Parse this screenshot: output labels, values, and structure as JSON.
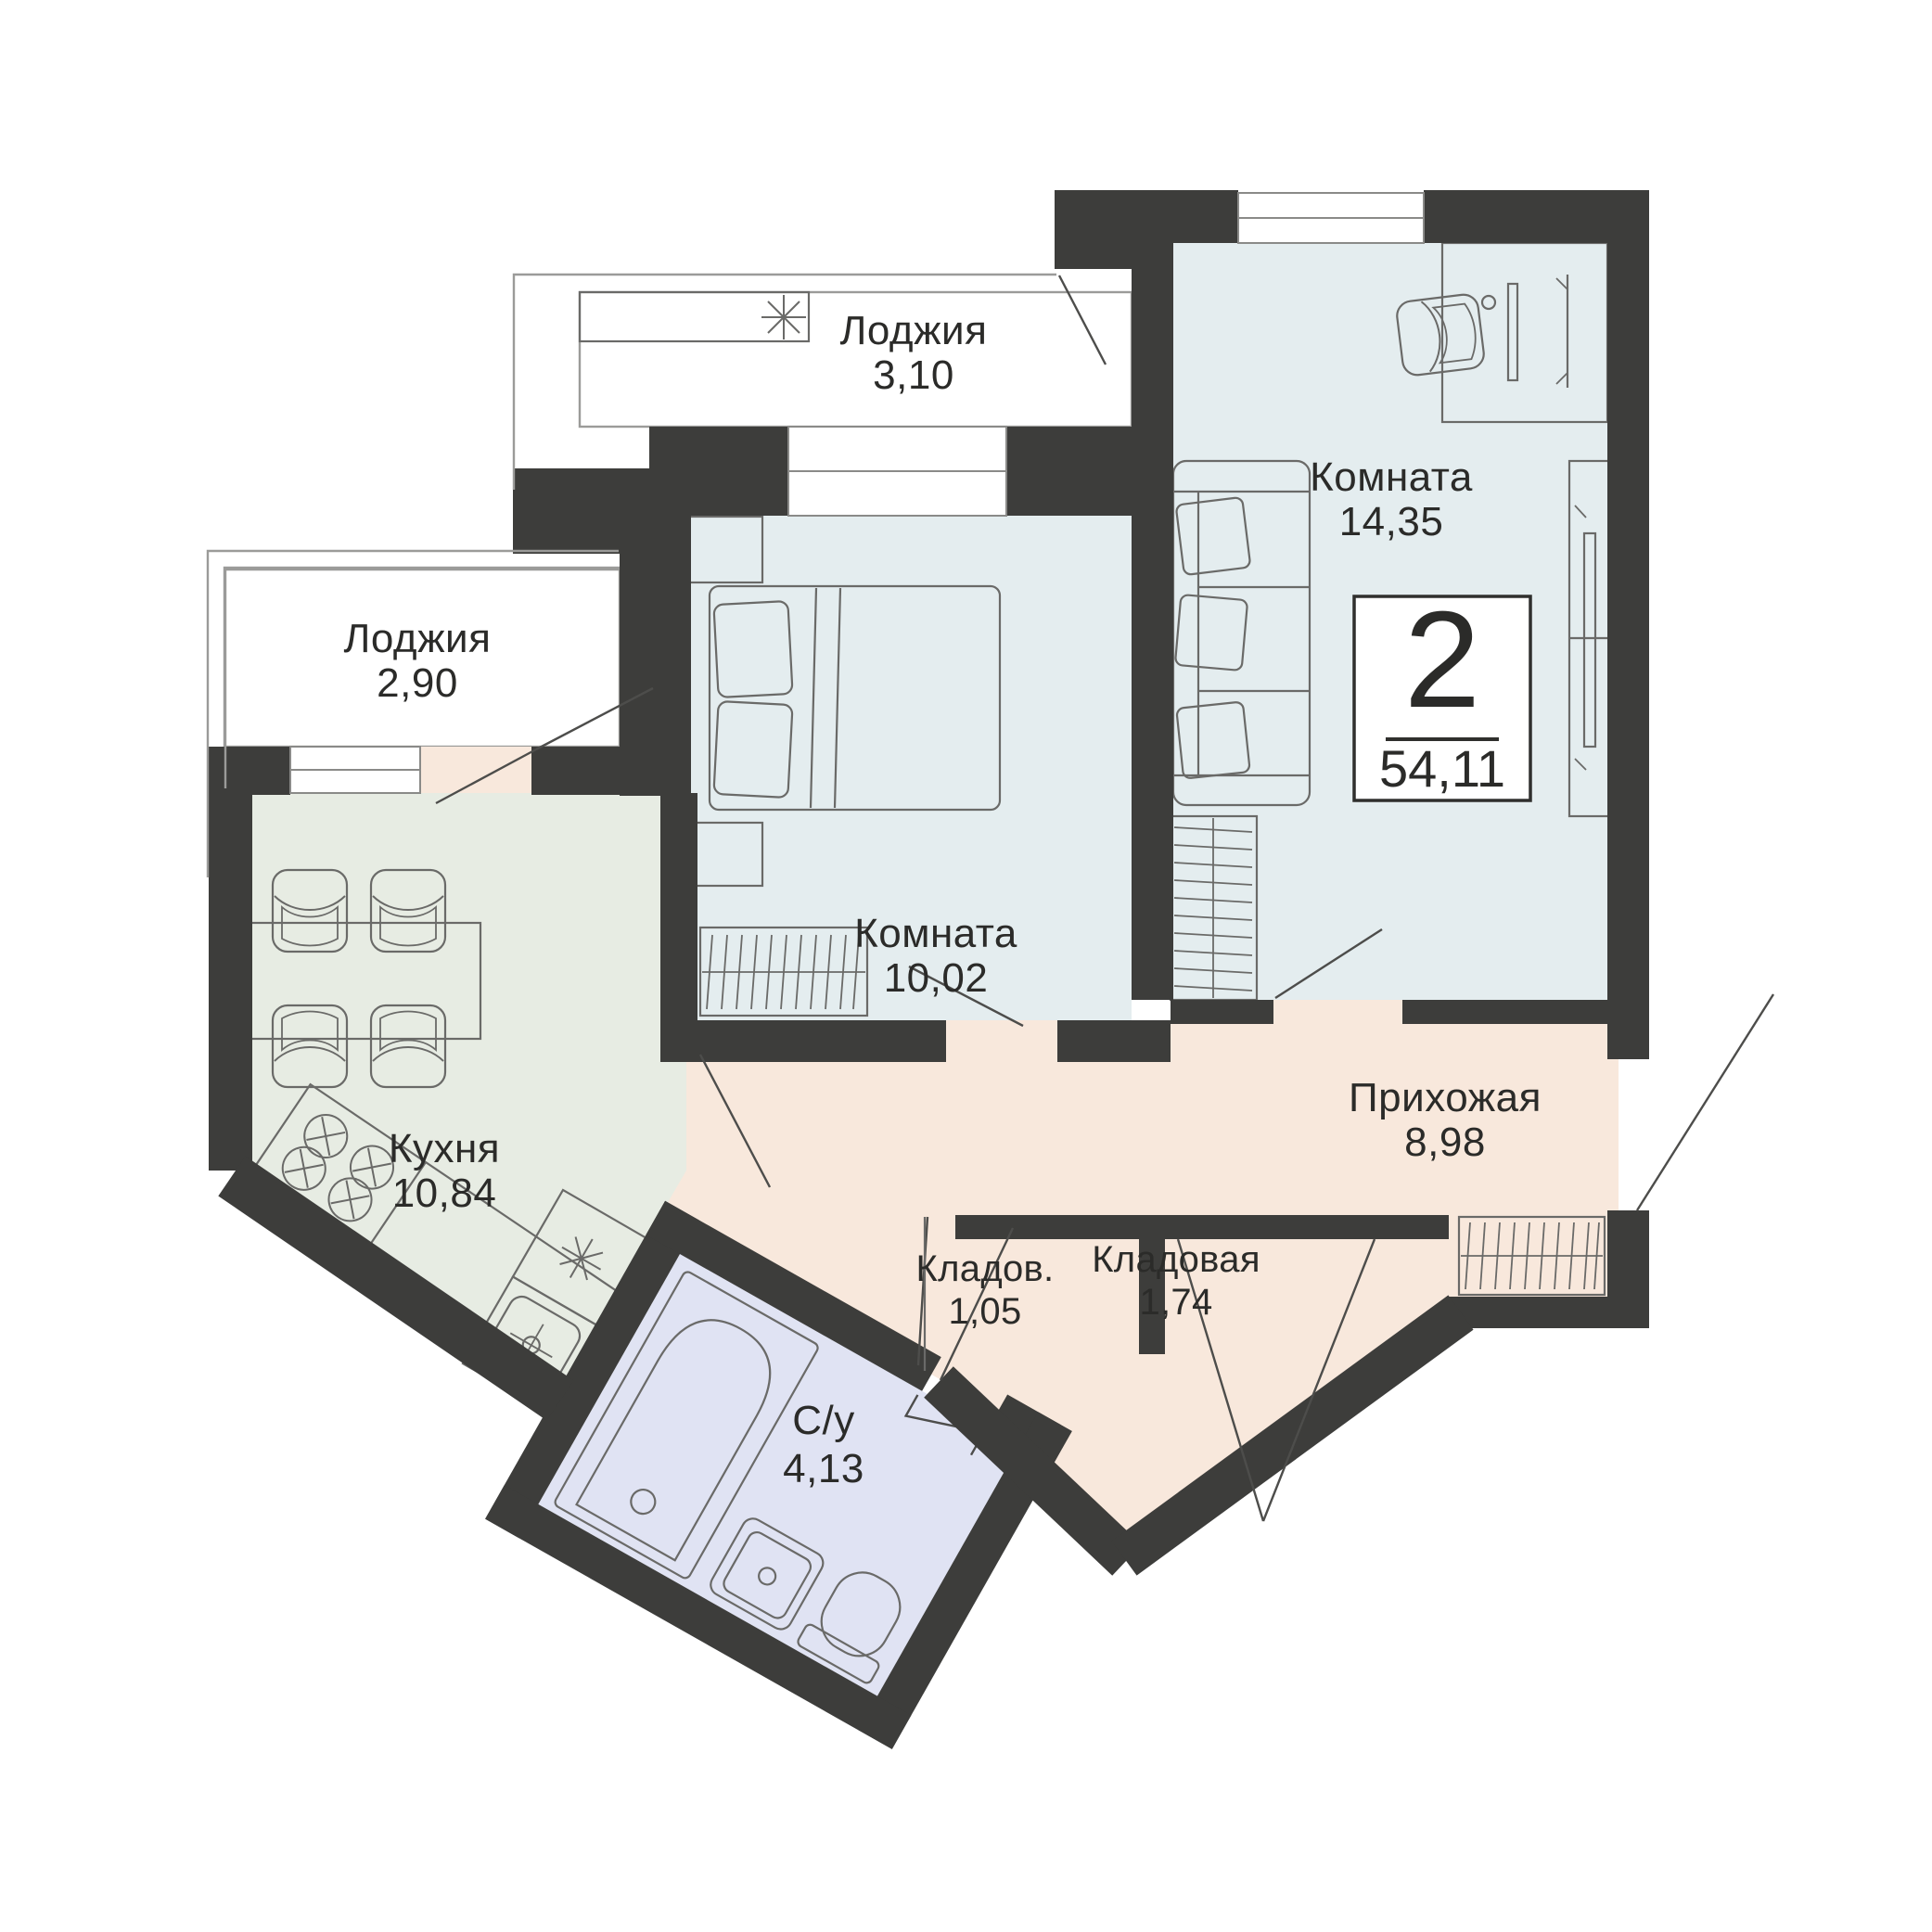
{
  "plan": {
    "badge": {
      "rooms_count": "2",
      "total_area": "54,11"
    },
    "rooms": {
      "loggia_top": {
        "name": "Лоджия",
        "area": "3,10"
      },
      "loggia_left": {
        "name": "Лоджия",
        "area": "2,90"
      },
      "room_large": {
        "name": "Комната",
        "area": "14,35"
      },
      "room_small": {
        "name": "Комната",
        "area": "10,02"
      },
      "kitchen": {
        "name": "Кухня",
        "area": "10,84"
      },
      "hallway": {
        "name": "Прихожая",
        "area": "8,98"
      },
      "storage_small": {
        "name": "Кладов.",
        "area": "1,05"
      },
      "storage": {
        "name": "Кладовая",
        "area": "1,74"
      },
      "bathroom": {
        "name": "С/у",
        "area": "4,13"
      }
    },
    "icons": {
      "loggia_unit": "snowflake",
      "fridge_unit": "snowflake"
    },
    "colors": {
      "wall": "#3d3d3b",
      "loggia_and_hall": "#f8e8dc",
      "living_rooms": "#e4edef",
      "kitchen": "#e7ece3",
      "bathroom": "#e0e3f3",
      "furniture_line": "#6a6a68"
    }
  }
}
